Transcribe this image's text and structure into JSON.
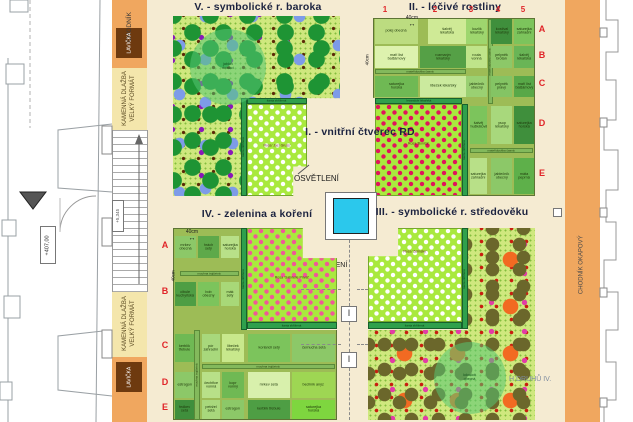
{
  "colors": {
    "plaza": "#F5EBD2",
    "walk_orange": "#F0A75F",
    "pavement_yellow": "#F4E6AC",
    "bench_brown": "#6E3A0F",
    "grid_green": "#9DBC56",
    "dotted_green": "#CFE87E",
    "rose_green": "#A9E93E",
    "hedge_dark": "#2FA04C",
    "hedge_light": "#83B95C",
    "water_cyan": "#2BC8EC",
    "label_red": "#E02428",
    "title_navy": "#1c2340"
  },
  "blocks": [
    {
      "name": "plaza",
      "r": [
        147,
        0,
        418,
        422
      ],
      "bg": "#F5EBD2"
    },
    {
      "name": "walkway-left-top",
      "r": [
        112,
        0,
        35,
        68
      ],
      "bg": "#F0A75F"
    },
    {
      "name": "pavement-left-top",
      "r": [
        112,
        68,
        35,
        62
      ],
      "bg": "#F4E6AC"
    },
    {
      "name": "stairs-left",
      "r": [
        112,
        130,
        36,
        162
      ],
      "cls": "stairs"
    },
    {
      "name": "pavement-left-bottom",
      "r": [
        112,
        292,
        35,
        65
      ],
      "bg": "#F4E6AC"
    },
    {
      "name": "walkway-left-bottom",
      "r": [
        112,
        357,
        35,
        65
      ],
      "bg": "#F0A75F"
    },
    {
      "name": "walkway-right",
      "r": [
        565,
        0,
        35,
        422
      ],
      "bg": "#F0A75F"
    },
    {
      "name": "building-right",
      "r": [
        600,
        0,
        33,
        422
      ],
      "bg": "#ffffff"
    },
    {
      "name": "bench-top",
      "r": [
        116,
        28,
        26,
        30
      ],
      "bg": "#6E3A0F"
    },
    {
      "name": "bench-bottom",
      "r": [
        116,
        362,
        26,
        30
      ],
      "bg": "#6E3A0F"
    },
    {
      "name": "light-frame",
      "r": [
        325,
        192,
        52,
        48
      ],
      "bg": "#ffffff",
      "border": "#777",
      "cls": "hi"
    },
    {
      "name": "water-basin",
      "r": [
        333,
        198,
        36,
        36
      ],
      "bg": "#2BC8EC",
      "border": "#222",
      "cls": "hi"
    },
    {
      "name": "light-fixture-1",
      "r": [
        341,
        306,
        16,
        16
      ],
      "bg": "#ffffff",
      "border": "#777",
      "cls": "hi"
    },
    {
      "name": "light-fixture-2",
      "r": [
        341,
        352,
        16,
        16
      ],
      "bg": "#ffffff",
      "border": "#777",
      "cls": "hi"
    },
    {
      "name": "marker-square",
      "r": [
        553,
        208,
        9,
        9
      ],
      "bg": "#ffffff",
      "border": "#777",
      "cls": "hi"
    }
  ],
  "quads": [
    {
      "name": "quadrant-v-baroque",
      "r": [
        173,
        16,
        167,
        180
      ],
      "cls": "quad dotted",
      "orn": "orn orn-v",
      "clip": "0 0,100% 0,100% 45.6%,40.7% 45.6%,40.7% 100%,0 100%"
    },
    {
      "name": "quadrant-ii-herbs",
      "r": [
        373,
        18,
        162,
        178
      ],
      "cls": "quad gridbase",
      "clip": "0 0,100% 0,100% 100%,54.9% 100%,54.9% 44.9%,0 44.9%"
    },
    {
      "name": "quadrant-iv-vegetables",
      "r": [
        173,
        228,
        164,
        192
      ],
      "cls": "quad gridbase",
      "clip": "0 0,41.5% 0,41.5% 53.1%,100% 53.1%,100% 100%,0 100%"
    },
    {
      "name": "quadrant-iii-medieval",
      "r": [
        368,
        228,
        167,
        192
      ],
      "cls": "quad dotted",
      "orn": "orn orn-iii",
      "clip": "59.9% 0,100% 0,100% 100%,0 100%,0 53.1%,59.9% 53.1%"
    }
  ],
  "strips": [
    {
      "t": "šanta zkřížená",
      "r": [
        247,
        98,
        60,
        6
      ],
      "v": false,
      "light": false
    },
    {
      "t": "šanta zkřížená",
      "r": [
        241,
        98,
        6,
        98
      ],
      "v": true,
      "light": false
    },
    {
      "t": "levandule lékařská",
      "r": [
        375,
        98,
        87,
        6
      ],
      "v": false,
      "light": false
    },
    {
      "t": "šanta zkřížená",
      "r": [
        462,
        104,
        6,
        92
      ],
      "v": true,
      "light": false
    },
    {
      "t": "šanta zkřížená",
      "r": [
        241,
        228,
        6,
        102
      ],
      "v": true,
      "light": false
    },
    {
      "t": "šanta zkřížená",
      "r": [
        247,
        322,
        90,
        7
      ],
      "v": false,
      "light": false
    },
    {
      "t": "šanta zkřížená",
      "r": [
        462,
        228,
        6,
        101
      ],
      "v": true,
      "light": false
    },
    {
      "t": "šanta zkřížená",
      "r": [
        368,
        322,
        94,
        7
      ],
      "v": false,
      "light": false
    },
    {
      "t": "mateřídouška časná",
      "r": [
        375,
        69,
        91,
        5
      ],
      "v": false,
      "light": true
    },
    {
      "t": "mateřídouška časná",
      "r": [
        488,
        19,
        5,
        85
      ],
      "v": true,
      "light": true
    },
    {
      "t": "mateřídouška časná",
      "r": [
        470,
        148,
        63,
        5
      ],
      "v": false,
      "light": true
    },
    {
      "t": "mochna trojčetná",
      "r": [
        180,
        271,
        59,
        5
      ],
      "v": false,
      "light": true
    },
    {
      "t": "mochna trojčetná",
      "r": [
        194,
        330,
        6,
        90
      ],
      "v": true,
      "light": true
    },
    {
      "t": "mochna trojčetná",
      "r": [
        202,
        364,
        133,
        5
      ],
      "v": false,
      "light": true
    }
  ],
  "roses": [
    {
      "t": "Rosa 'Jací Gruss'",
      "r": [
        247,
        104,
        60,
        92
      ],
      "dot": "#FFFFFF",
      "lt": "42%",
      "clip": "0 0,100% 0,100% 68%,77% 68%,77% 100%,0 100%"
    },
    {
      "t": "Rosa 'Bonica'",
      "r": [
        375,
        104,
        87,
        92
      ],
      "dot": "#E0145C",
      "lt": "40%",
      "clip": ""
    },
    {
      "t": "Rosa 'Gabrielle Privat'",
      "r": [
        247,
        228,
        90,
        94
      ],
      "dot": "#F05898",
      "lt": "50%",
      "clip": "0 0,62% 0,62% 32%,100% 32%,100% 100%,0 100%"
    },
    {
      "t": "Rosa 'Zelinsky'",
      "r": [
        368,
        228,
        94,
        94
      ],
      "dot": "#FFFFFF",
      "lt": "22%",
      "clip": "32% 0,100% 0,100% 100%,0 100%,0 30%,32% 30%"
    }
  ],
  "trees": [
    {
      "t": "jabloň\ndomácí",
      "r": [
        190,
        29,
        76,
        76
      ]
    },
    {
      "t": "kdouloň\nobecná",
      "r": [
        434,
        342,
        72,
        72
      ]
    }
  ],
  "cells": [
    {
      "t": "polej obecná",
      "r": [
        375,
        19,
        43,
        25
      ],
      "bg": "#BCDC80"
    },
    {
      "t": "šalvěj lékařská",
      "r": [
        428,
        19,
        38,
        25
      ],
      "bg": "#CFEA96"
    },
    {
      "t": "kozlík lékařský",
      "r": [
        466,
        19,
        21,
        25
      ],
      "bg": "#9ED66E"
    },
    {
      "t": "kostival lékařský",
      "r": [
        491,
        19,
        21,
        25
      ],
      "bg": "#3F8F3C"
    },
    {
      "t": "saturejka zahradní",
      "r": [
        514,
        19,
        20,
        25
      ],
      "bg": "#7CC45C"
    },
    {
      "t": "maří list balšámový",
      "r": [
        375,
        46,
        43,
        22
      ],
      "bg": "#DDF2AE"
    },
    {
      "t": "rozmarýn lékařský",
      "r": [
        420,
        46,
        46,
        22
      ],
      "bg": "#55A046"
    },
    {
      "t": "routa vonná",
      "r": [
        466,
        46,
        21,
        22
      ],
      "bg": "#BFE48A"
    },
    {
      "t": "pelyněk brotan",
      "r": [
        491,
        46,
        21,
        22
      ],
      "bg": "#8CC868"
    },
    {
      "t": "šalvěj lékařská",
      "r": [
        514,
        46,
        20,
        22
      ],
      "bg": "#69B556"
    },
    {
      "t": "saturejka horská",
      "r": [
        375,
        76,
        43,
        21
      ],
      "bg": "#6FB954"
    },
    {
      "t": "libeček lékařský",
      "r": [
        420,
        76,
        46,
        21
      ],
      "bg": "#CBEA9E"
    },
    {
      "t": "jablečník obecný",
      "r": [
        466,
        76,
        21,
        21
      ],
      "bg": "#9AD072"
    },
    {
      "t": "pelyněk pravý",
      "r": [
        491,
        76,
        21,
        21
      ],
      "bg": "#84C464"
    },
    {
      "t": "maří list balšámový",
      "r": [
        514,
        76,
        20,
        21
      ],
      "bg": "#58A848"
    },
    {
      "t": "šalvěj muškátová",
      "r": [
        470,
        106,
        17,
        38
      ],
      "bg": "#7CC45C"
    },
    {
      "t": "ysop lékařský",
      "r": [
        491,
        106,
        21,
        38
      ],
      "bg": "#A8D87C"
    },
    {
      "t": "saturejka horská",
      "r": [
        514,
        106,
        20,
        38
      ],
      "bg": "#3F8F3C"
    },
    {
      "t": "saturejka zahradní",
      "r": [
        470,
        158,
        17,
        36
      ],
      "bg": "#B8E088"
    },
    {
      "t": "jablečník obecný",
      "r": [
        491,
        158,
        21,
        36
      ],
      "bg": "#8CC868"
    },
    {
      "t": "máta peprná",
      "r": [
        514,
        158,
        20,
        36
      ],
      "bg": "#5EB04A"
    },
    {
      "t": "mrkev obecná",
      "r": [
        175,
        236,
        21,
        22
      ],
      "bg": "#8CC868"
    },
    {
      "t": "hrách setý",
      "r": [
        198,
        236,
        21,
        22
      ],
      "bg": "#5EA94A"
    },
    {
      "t": "saturejka horská",
      "r": [
        221,
        236,
        18,
        22
      ],
      "bg": "#B8E088"
    },
    {
      "t": "cibule kuchyňská",
      "r": [
        175,
        282,
        21,
        24
      ],
      "bg": "#4E9E44"
    },
    {
      "t": "bob obecný",
      "r": [
        198,
        282,
        21,
        24
      ],
      "bg": "#7CC45C"
    },
    {
      "t": "mák setý",
      "r": [
        221,
        282,
        18,
        24
      ],
      "bg": "#A8D878"
    },
    {
      "t": "kerblík třebule",
      "r": [
        175,
        334,
        19,
        28
      ],
      "bg": "#6FB954"
    },
    {
      "t": "pór zahradní",
      "r": [
        202,
        334,
        18,
        28
      ],
      "bg": "#A8D87C"
    },
    {
      "t": "libeček lékařský",
      "r": [
        222,
        334,
        22,
        28
      ],
      "bg": "#C8E88C"
    },
    {
      "t": "koriandr setý",
      "r": [
        248,
        334,
        42,
        28
      ],
      "bg": "#7CC45C"
    },
    {
      "t": "černucha setá",
      "r": [
        292,
        334,
        43,
        28
      ],
      "bg": "#8CC868"
    },
    {
      "t": "estragon",
      "r": [
        175,
        372,
        19,
        26
      ],
      "bg": "#8CC868"
    },
    {
      "t": "čechřice vonná",
      "r": [
        202,
        372,
        18,
        26
      ],
      "bg": "#B8E088"
    },
    {
      "t": "kopr vonný",
      "r": [
        222,
        372,
        22,
        26
      ],
      "bg": "#6FB954"
    },
    {
      "t": "mrkev setá",
      "r": [
        248,
        372,
        42,
        26
      ],
      "bg": "#D8F0AC"
    },
    {
      "t": "bedrník anýz",
      "r": [
        292,
        372,
        43,
        26
      ],
      "bg": "#9ED653"
    },
    {
      "t": "ředkev setá",
      "r": [
        175,
        400,
        19,
        19
      ],
      "bg": "#3F8F3C"
    },
    {
      "t": "petržel setá",
      "r": [
        202,
        400,
        18,
        19
      ],
      "bg": "#A8D87C"
    },
    {
      "t": "estragon",
      "r": [
        222,
        400,
        22,
        19
      ],
      "bg": "#8CC868"
    },
    {
      "t": "kerblík třebule",
      "r": [
        248,
        400,
        42,
        19
      ],
      "bg": "#4E9E44"
    },
    {
      "t": "saturejka horská",
      "r": [
        292,
        400,
        43,
        19
      ],
      "bg": "#7ED63F"
    }
  ],
  "dashes": {
    "v": [
      [
        349,
        240,
        66
      ],
      [
        349,
        322,
        30
      ],
      [
        349,
        368,
        52
      ]
    ],
    "h": [
      [
        301,
        289,
        40
      ],
      [
        301,
        344,
        40
      ],
      [
        357,
        289,
        11
      ],
      [
        357,
        344,
        11
      ]
    ]
  },
  "texts": [
    {
      "t": "V. - symbolické r. baroka",
      "x": 178,
      "y": 1,
      "w": 160,
      "fs": 10.5,
      "cls": "title center",
      "name": "title-quadrant-v"
    },
    {
      "t": "II. - léčivé rostliny",
      "x": 375,
      "y": 1,
      "w": 160,
      "fs": 10.5,
      "cls": "title center",
      "name": "title-quadrant-ii"
    },
    {
      "t": "I. - vnitřní čtverec RD",
      "x": 296,
      "y": 126,
      "w": 128,
      "fs": 10.5,
      "cls": "title center",
      "name": "title-quadrant-i"
    },
    {
      "t": "IV. - zelenina a koření",
      "x": 177,
      "y": 208,
      "w": 160,
      "fs": 10.5,
      "cls": "title center",
      "name": "title-quadrant-iv"
    },
    {
      "t": "III. - symbolické r. středověku",
      "x": 366,
      "y": 206,
      "w": 172,
      "fs": 10.5,
      "cls": "title center",
      "name": "title-quadrant-iii"
    },
    {
      "t": "OSVĚTLENÍ",
      "x": 294,
      "y": 174,
      "fs": 8,
      "c": "#1a1a1a",
      "name": "lighting-label-1"
    },
    {
      "t": "OSVĚTLENÍ",
      "x": 308,
      "y": 262,
      "fs": 7,
      "c": "#1a1a1a",
      "z": 1,
      "name": "lighting-label-2"
    },
    {
      "t": "H DRUHŮ IV.",
      "x": 509,
      "y": 376,
      "fs": 7,
      "c": "#7E8CA0",
      "name": "species-list-label"
    },
    {
      "t": "40cm",
      "x": 402,
      "y": 15,
      "w": 20,
      "fs": 5,
      "c": "#222",
      "cls": "center",
      "name": "dim-40cm-ii-top"
    },
    {
      "t": "↔",
      "x": 402,
      "y": 21,
      "w": 20,
      "fs": 7,
      "c": "#111",
      "cls": "center",
      "name": "dim-arrow-ii-top"
    },
    {
      "t": "40cm",
      "x": 182,
      "y": 229,
      "w": 20,
      "fs": 5,
      "c": "#222",
      "cls": "center",
      "name": "dim-40cm-iv-top"
    },
    {
      "t": "↔",
      "x": 182,
      "y": 235,
      "w": 20,
      "fs": 7,
      "c": "#111",
      "cls": "center",
      "name": "dim-arrow-iv-top"
    },
    {
      "t": "1",
      "x": 380,
      "y": 5,
      "w": 10,
      "fs": 8,
      "cls": "red center",
      "name": "col-number-1"
    },
    {
      "t": "2",
      "x": 430,
      "y": 5,
      "w": 10,
      "fs": 8,
      "cls": "red center",
      "name": "col-number-2"
    },
    {
      "t": "3",
      "x": 466,
      "y": 5,
      "w": 10,
      "fs": 8,
      "cls": "red center",
      "name": "col-number-3"
    },
    {
      "t": "4",
      "x": 493,
      "y": 5,
      "w": 10,
      "fs": 8,
      "cls": "red center",
      "name": "col-number-4"
    },
    {
      "t": "5",
      "x": 518,
      "y": 5,
      "w": 10,
      "fs": 8,
      "cls": "red center",
      "name": "col-number-5"
    },
    {
      "t": "A",
      "x": 537,
      "y": 24,
      "w": 10,
      "fs": 9,
      "cls": "red center",
      "name": "row-letter-ii-a"
    },
    {
      "t": "B",
      "x": 537,
      "y": 50,
      "w": 10,
      "fs": 9,
      "cls": "red center",
      "name": "row-letter-ii-b"
    },
    {
      "t": "C",
      "x": 537,
      "y": 78,
      "w": 10,
      "fs": 9,
      "cls": "red center",
      "name": "row-letter-ii-c"
    },
    {
      "t": "D",
      "x": 537,
      "y": 118,
      "w": 10,
      "fs": 9,
      "cls": "red center",
      "name": "row-letter-ii-d"
    },
    {
      "t": "E",
      "x": 537,
      "y": 168,
      "w": 10,
      "fs": 9,
      "cls": "red center",
      "name": "row-letter-ii-e"
    },
    {
      "t": "A",
      "x": 160,
      "y": 240,
      "w": 10,
      "fs": 9,
      "cls": "red center",
      "name": "row-letter-iv-a"
    },
    {
      "t": "B",
      "x": 160,
      "y": 286,
      "w": 10,
      "fs": 9,
      "cls": "red center",
      "name": "row-letter-iv-b"
    },
    {
      "t": "C",
      "x": 160,
      "y": 340,
      "w": 10,
      "fs": 9,
      "cls": "red center",
      "name": "row-letter-iv-c"
    },
    {
      "t": "D",
      "x": 160,
      "y": 377,
      "w": 10,
      "fs": 9,
      "cls": "red center",
      "name": "row-letter-iv-d"
    },
    {
      "t": "E",
      "x": 160,
      "y": 402,
      "w": 10,
      "fs": 9,
      "cls": "red center",
      "name": "row-letter-iv-e"
    },
    {
      "t": "I",
      "x": 341,
      "y": 308,
      "w": 16,
      "fs": 9,
      "c": "#333",
      "cls": "center",
      "z": 4,
      "name": "fixture-glyph-1"
    },
    {
      "t": "I",
      "x": 341,
      "y": 354,
      "w": 16,
      "fs": 9,
      "c": "#333",
      "cls": "center",
      "z": 4,
      "name": "fixture-glyph-2"
    }
  ],
  "vtexts": [
    {
      "t": "CHODNÍK",
      "x": 112,
      "y": 2,
      "w": 35,
      "h": 50,
      "fs": 6.5,
      "c": "#3a3a3a",
      "name": "sidewalk-label-top"
    },
    {
      "t": "KAMENNÁ DLAŽBA\nVELKÝ FORMÁT",
      "x": 112,
      "y": 66,
      "w": 35,
      "h": 64,
      "fs": 6,
      "c": "#5a4a22",
      "name": "stone-paving-label-top"
    },
    {
      "t": "KAMENNÁ DLAŽBA\nVELKÝ FORMÁT",
      "x": 112,
      "y": 290,
      "w": 35,
      "h": 67,
      "fs": 6,
      "c": "#5a4a22",
      "name": "stone-paving-label-bottom"
    },
    {
      "t": "CHODNÍK OKAPOVÝ",
      "x": 565,
      "y": 215,
      "w": 35,
      "h": 100,
      "fs": 6,
      "c": "#4a4a4a",
      "name": "eaves-sidewalk-label"
    },
    {
      "t": "LAVIČKA",
      "x": 116,
      "y": 28,
      "w": 26,
      "h": 30,
      "fs": 5,
      "c": "#ffffff",
      "name": "bench-label-top"
    },
    {
      "t": "LAVIČKA",
      "x": 116,
      "y": 362,
      "w": 26,
      "h": 30,
      "fs": 5,
      "c": "#ffffff",
      "name": "bench-label-bottom"
    },
    {
      "t": "+407,00",
      "x": 40,
      "y": 226,
      "w": 16,
      "h": 38,
      "fs": 5.5,
      "c": "#333",
      "box": true,
      "name": "level-mark"
    },
    {
      "t": "+5,345",
      "x": 112,
      "y": 200,
      "w": 12,
      "h": 32,
      "fs": 4.5,
      "c": "#555",
      "box": true,
      "name": "dim-5345"
    },
    {
      "t": "40cm",
      "x": 362,
      "y": 44,
      "w": 12,
      "h": 32,
      "fs": 4.5,
      "c": "#222",
      "name": "dim-40cm-ii-left"
    },
    {
      "t": "40cm",
      "x": 168,
      "y": 260,
      "w": 12,
      "h": 32,
      "fs": 4.5,
      "c": "#222",
      "name": "dim-40cm-iv-left"
    }
  ]
}
